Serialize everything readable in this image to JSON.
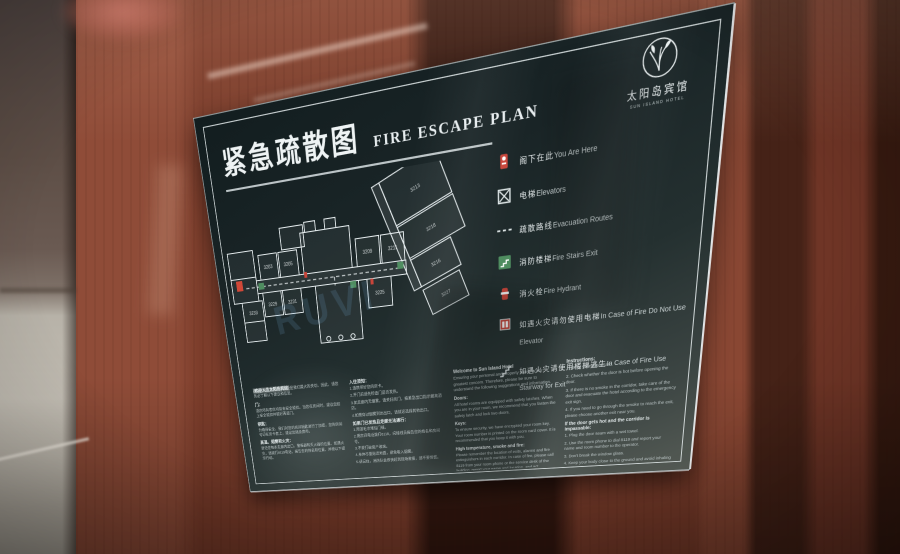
{
  "logo": {
    "zh": "太阳岛宾馆",
    "en": "SUN ISLAND HOTEL"
  },
  "title": {
    "zh": "紧急疏散图",
    "en": "FIRE ESCAPE PLAN"
  },
  "legend": [
    {
      "icon": "you-are-here",
      "zh": "阁下在此",
      "en": "You Are Here"
    },
    {
      "icon": "elevator",
      "zh": "电梯",
      "en": "Elevators"
    },
    {
      "icon": "evacuation-route",
      "zh": "疏散路线",
      "en": "Evacuation Routes"
    },
    {
      "icon": "fire-stairs",
      "zh": "消防楼梯",
      "en": "Fire Stairs Exit"
    },
    {
      "icon": "fire-hydrant",
      "zh": "消火栓",
      "en": "Fire Hydrant"
    },
    {
      "icon": "no-elevator",
      "zh": "如遇火灾请勿使用电梯",
      "en": "In Case of Fire Do Not Use Elevator"
    },
    {
      "icon": "stairway-exit",
      "zh": "如遇火灾请使用楼梯逃生",
      "en": "In Case of Fire Use Stairway for Exit"
    }
  ],
  "plan": {
    "rooms": [
      "3213",
      "3218",
      "3216",
      "3203",
      "3205",
      "3209",
      "3211",
      "3229",
      "3231",
      "3233",
      "3225",
      "3227"
    ],
    "watermark": "RUVI"
  },
  "columns": {
    "zh_info": {
      "title": "欢迎入住太阳岛宾馆",
      "intro": "确保您的人身和财产安全是我们最大的关切。因此，请您务必了解以下建议和信息。",
      "s1h": "门：",
      "s1t": "酒店所有客房均装有安全锁扣。当您在房间时，建议您扣上安全锁扣并锁好两道门。",
      "s2h": "钥匙：",
      "s2t": "为确保安全，我们对您的房间钥匙进行了加密，您的房间号印在房卡套上，建议您随身携带。",
      "s3h": "高温、烟雾和火灾：",
      "s3t": "请记住每条走廊内出口、警报器和灭火器的位置。如遇火灾，请拨打8119电话，报告您的姓名和位置，并按以下提示行动。"
    },
    "zh_steps": {
      "title": "入住须知：",
      "i1": "1.请携带好您的房卡。",
      "i2": "2.开门前请先检查门是否发热。",
      "i3": "3.如走廊内无烟雾，请关好房门，按紧急出口指示撤离酒店。",
      "i4": "4.如需穿过烟雾到达出口，请就近选择其他出口。",
      "title2": "如果门已发热且走廊无法通行：",
      "j1": "1.用湿毛巾堵住门缝。",
      "j2": "2.用房间电话拨打8119，向接线员报告您的姓名和房间号。",
      "j3": "3.不要打破窗户玻璃。",
      "j4": "4.身体尽量贴近地面，避免吸入烟雾。",
      "j5": "5.请记住，消防队会很快赶到现场救援，请不要惊慌。"
    },
    "en_info": {
      "title": "Welcome to Sun Island Hotel",
      "intro": "Ensuring your personal and property safety is our greatest concern. Therefore, please be sure to understand the following suggestions and information.",
      "s1h": "Doors:",
      "s1t": "All hotel rooms are equipped with safety latches. When you are in your room, we recommend that you fasten the safety latch and lock two doors.",
      "s2h": "Keys:",
      "s2t": "To ensure security, we have encrypted your room key. Your room number is printed on the room card cover. It is recommended that you keep it with you.",
      "s3h": "High temperature, smoke and fire:",
      "s3t": "Please remember the location of exits, alarms and fire extinguishers in each corridor. In case of fire, please call 8119 from your room phone or the service desk of the building, report your name and location, and act according to the following."
    },
    "en_steps": {
      "title": "Instructions:",
      "i1": "1. Bring your room card.",
      "i2": "2. Check whether the door is hot before opening the door.",
      "i3": "3. If there is no smoke in the corridor, take care of the door and evacuate the hotel according to the emergency exit sign.",
      "i4": "4. If you need to go through the smoke to reach the exit, please choose another exit near you.",
      "title2": "If the door gets hot and the corridor is impassable:",
      "j1": "1. Plug the door seam with a wet towel.",
      "j2": "2. Use the room phone to dial 8119 and report your name and room number to the operator.",
      "j3": "3. Don't break the window glass.",
      "j4": "4. Keep your body close to the ground and avoid inhaling smoke.",
      "j5": "5. Remember, the fire brigade will arrive at the scene quickly for rescue. Please don't panic.",
      "footer": "The above are fire prevention instructions. If you have any questions, please contact the building safety department."
    }
  },
  "colors": {
    "panel": "#1e2a2c",
    "frame": "#e8eff0",
    "accent_red": "#c8453a",
    "accent_green": "#4f8d60",
    "plan_stroke": "#e7eef0",
    "wood": "#7c3d2b",
    "watermark_blue": "#82b9eb"
  }
}
